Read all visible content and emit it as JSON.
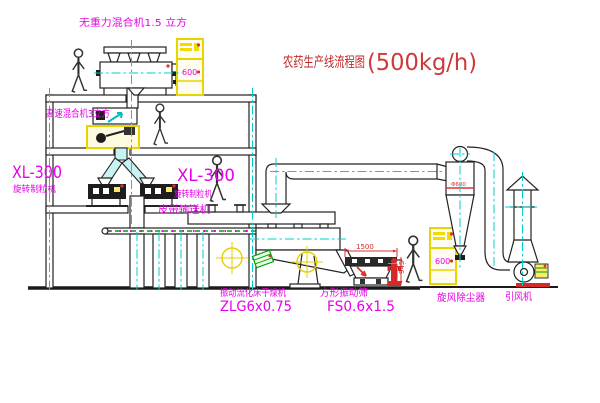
{
  "title": {
    "name": "农药生产线流程图",
    "capacity": "(500kg/h)"
  },
  "labels": {
    "gravity_mixer": "无重力混合机1.5 立方",
    "high_speed_mixer": "高速混合机3立方",
    "granulator_left_model": "XL-300",
    "granulator_left_name": "旋转制粒机",
    "granulator_right_model": "XL-300",
    "granulator_right_name": "旋转制粒机",
    "belt_conveyor": "皮带输送机",
    "dryer_name": "振动流化床干燥机",
    "dryer_model": "ZLG6x0.75",
    "screen_name": "方形振动筛",
    "screen_model": "FS0.6x1.5",
    "cyclone": "旋风除尘器",
    "fan": "引风机"
  },
  "dimensions": {
    "screen_length": "1500",
    "screen_height": "945",
    "cyclone_diameter": "Φ600"
  },
  "cabinets": {
    "cabinet1_code": "600",
    "cabinet2_code": "600"
  },
  "icons": {
    "worker": "person-figure",
    "center_mark": "crosshair-mark",
    "cabinet": "control-cabinet",
    "hydrant": "fire-hydrant"
  },
  "colors": {
    "line": "#222222",
    "centerline_cyan": "#00cdcd",
    "label_magenta": "#e800e8",
    "title_red": "#c42626",
    "equipment_yellow": "#e8d400",
    "conveyor_green": "#00a000",
    "dot_red": "#e03030"
  }
}
